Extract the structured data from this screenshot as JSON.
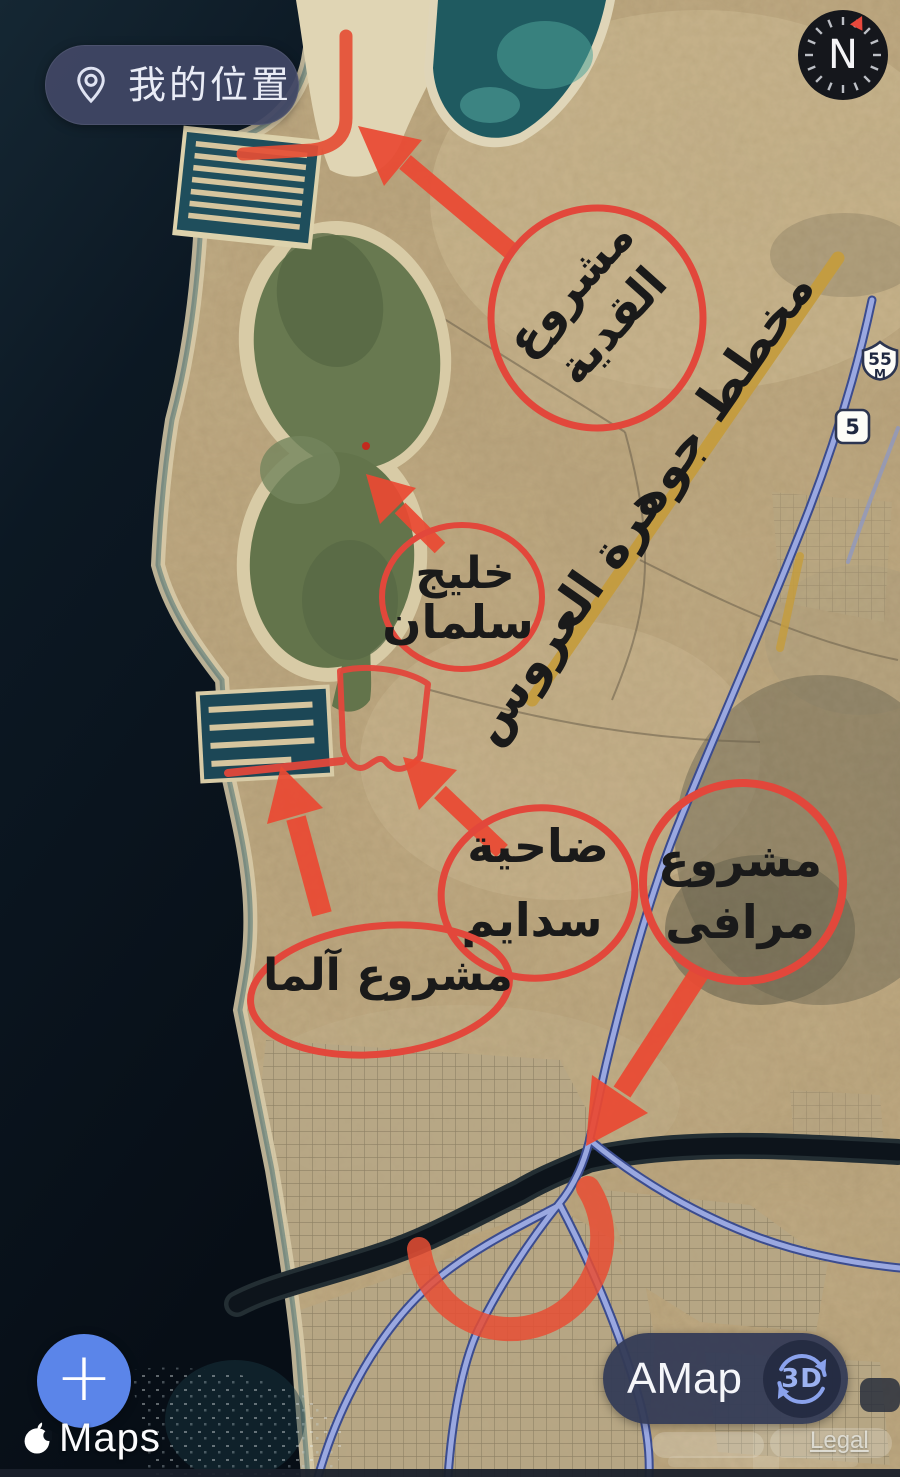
{
  "ui": {
    "my_location_label": "我的位置",
    "compass_n": "N",
    "shield_55": "55",
    "shield_55_suffix": "M",
    "shield_5": "5",
    "zoom_in_label": "+",
    "apple_maps_brand": "Maps",
    "amap_label": "AMap",
    "mode_3d_label": "3D",
    "legal_label": "Legal"
  },
  "annotations": {
    "qiddiya": {
      "line1": "مشروع",
      "line2": "القدية"
    },
    "jawharat_alarous": {
      "label": "مخطط جوهرة العروس"
    },
    "salman_bay": {
      "line1": "خليج",
      "line2": "سلمان"
    },
    "sadayem": {
      "line1": "ضاحية",
      "line2": "سدايم"
    },
    "marafy": {
      "line1": "مشروع",
      "line2": "مرافى"
    },
    "alma": {
      "label": "مشروع آلما"
    }
  },
  "colors": {
    "annotation_red": "#e2473b",
    "route_gold": "#c49c3e",
    "road_blue": "#94a3dd",
    "sea_dark": "#0a141d",
    "ui_navy": "#404764",
    "zoom_button_blue": "#5b85e9"
  }
}
